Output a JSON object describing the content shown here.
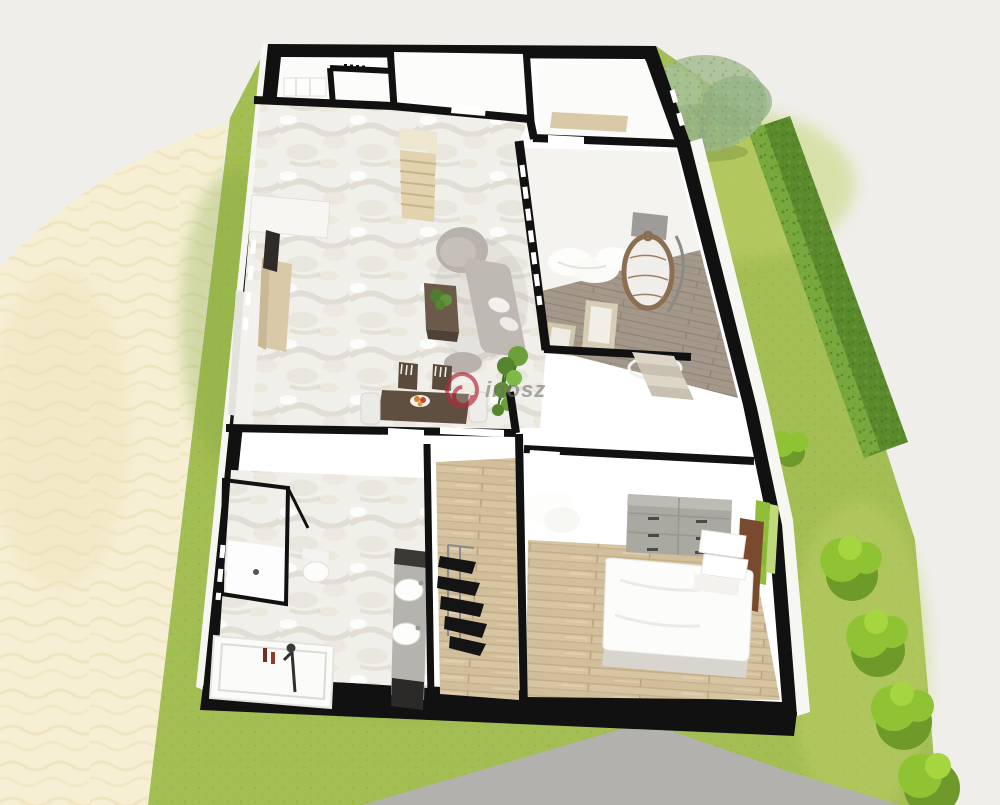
{
  "colors": {
    "background": "#EFEEEA",
    "sand": "#F6EFD4",
    "lawn": "#A3BE53",
    "lawn-light": "#C2D36C",
    "lawn-dark": "#7FA53C",
    "hedge": "#5B8A2D",
    "hedge-light": "#79A93E",
    "bush": "#8FC334",
    "bush-dark": "#6E9A2A",
    "tree-foliage": "#9FB98C",
    "trunk": "#7B5F40",
    "driveway": "#B2B1AE",
    "wall": "#111111",
    "interior": "#FFFFFF",
    "wall-face": "#F6F6F3",
    "marble": "#F1EFE9",
    "wood": "#D7C4A2",
    "deck": "#A4988A",
    "counter": "#D9C9A8",
    "stairs": "#E2D3AE",
    "sofa": "#B9B2AC",
    "dark-furniture": "#5F4F41",
    "dresser": "#A9A8A1",
    "white-furniture": "#FCFCFA",
    "accent-green": "#8FBE3A",
    "plant": "#5F9038",
    "clothes": "#141414",
    "steel": "#B5B3AE",
    "watermark-red": "#B5293A",
    "watermark-text": "#6F6E6A"
  },
  "scene": {
    "view": "3d-isometric-floor-plan-render",
    "watermark": {
      "text": "inosz"
    },
    "environment": [
      "sand-dunes",
      "lawn",
      "hedge-row",
      "tree",
      "bushes",
      "driveway"
    ],
    "rooms": [
      {
        "name": "entry-hall",
        "furniture": [
          "shelf-unit"
        ]
      },
      {
        "name": "storage-room",
        "furniture": []
      },
      {
        "name": "utility-room",
        "furniture": [
          "counter"
        ]
      },
      {
        "name": "living-room",
        "furniture": [
          "kitchen-counter",
          "tall-cabinet",
          "tv-panel",
          "curved-sofa",
          "coffee-table",
          "table-plant",
          "dining-table",
          "dining-chairs",
          "fruit-bowl",
          "potted-plant",
          "staircase"
        ]
      },
      {
        "name": "terrace",
        "furniture": [
          "hanging-egg-chair",
          "lounge-chairs",
          "day-bed",
          "garden-steps",
          "deck-ring-rug"
        ]
      },
      {
        "name": "bathroom",
        "furniture": [
          "glass-shower",
          "toilet",
          "bathtub",
          "freestanding-faucet",
          "double-sink-vanity",
          "toiletry-bottles"
        ]
      },
      {
        "name": "wardrobe-nook",
        "furniture": [
          "clothes-rack"
        ]
      },
      {
        "name": "bedroom",
        "furniture": [
          "double-bed",
          "pillows",
          "headboard",
          "green-accent-panels",
          "six-drawer-dresser",
          "fluffy-rug"
        ]
      }
    ]
  }
}
